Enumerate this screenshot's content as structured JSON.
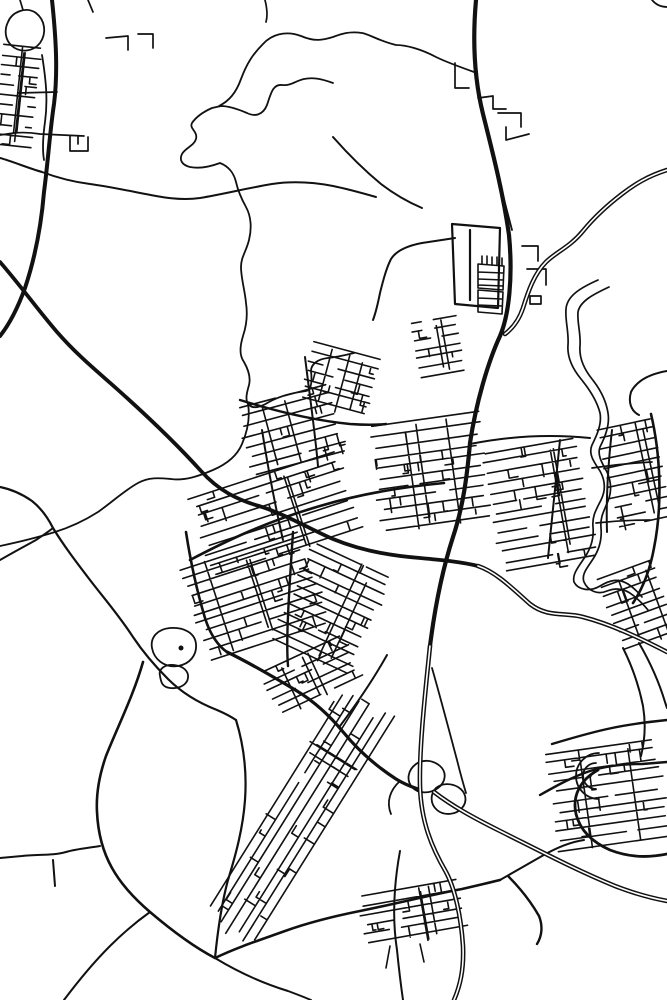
{
  "map": {
    "kind": "monochrome-street-map",
    "canvas": {
      "width": 667,
      "height": 1000,
      "background": "#ffffff",
      "ink": "#111111"
    },
    "water_boundaries": [
      {
        "n": "boundary-north-a",
        "w": 1.8,
        "d": "M 333,83 C 322,79 313,77 304,79 C 295,81 291,86 282,85 C 273,84 271,93 267,105 C 263,115 255,117 247,113 C 240,110 230,106 221,106 L 212,108 C 203,112 196,117 192,123 C 189,129 198,131 196,139 C 194,146 185,148 182,154 C 179,160 182,165 190,167 C 200,169 212,166 220,163 C 230,167 234,174 236,182 C 238,191 241,198 246,207 C 251,216 252,228 249,240 C 246,252 241,257 241,267 C 241,278 245,291 246,303 C 248,316 246,327 243,336 C 240,346 239,355 244,362 C 248,369 251,377 249,385 C 247,392 245,399 248,404 C 253,410 261,407 269,402 C 278,397 291,393 306,391 C 312,390 312,380 311,371 C 311,364 318,359 328,358 C 337,357 346,355 354,353"
      },
      {
        "n": "boundary-north-b",
        "w": 1.8,
        "d": "M 474,72 C 460,67 442,60 436,57 C 421,49 406,45 396,45 C 379,41 369,34 362,33 C 349,31 341,34 333,37 C 323,40 315,42 301,36 C 285,30 271,35 263,44 C 253,54 247,63 241,79 C 236,93 229,101 219,106"
      },
      {
        "n": "stream-nw-edge",
        "w": 1.8,
        "d": "M 248,404 C 250,416 248,430 242,444 C 237,456 227,464 213,470 C 199,476 185,481 171,479 C 159,478 149,477 138,483 C 125,490 111,503 98,512 C 87,519 71,527 55,532 C 39,537 19,542 0,546"
      },
      {
        "n": "river-bank-west",
        "w": 1.7,
        "d": "M 598,280 C 580,288 567,296 566,309 C 565,321 569,332 568,345 C 567,357 572,368 581,379 C 590,390 597,401 600,413 C 602,424 597,435 592,445 C 588,454 594,462 600,471 C 605,480 606,490 601,500 C 596,510 592,516 593,527 C 594,538 591,548 585,557 C 579,566 572,574 574,582 C 578,590 590,592 600,586 C 610,580 618,578 628,584 C 634,588 638,592 642,597"
      },
      {
        "n": "river-bank-east",
        "w": 1.7,
        "d": "M 609,287 C 594,294 580,301 578,312 C 577,323 581,333 580,346 C 579,358 584,369 592,379 C 600,389 606,400 608,413 C 610,425 605,437 600,447 C 597,455 602,463 607,472 C 611,481 612,491 608,501 C 604,511 600,517 601,528 C 602,539 599,550 593,559 C 588,567 581,574 584,582 C 588,591 598,595 607,591 C 617,587 626,589 634,596 C 640,601 644,605 648,610"
      }
    ],
    "features": [
      {
        "n": "village-loop-road",
        "w": 1.8,
        "d": "M 8,22 C 12,12 26,6 36,13 C 45,20 47,33 40,43 C 33,52 20,53 12,46 C 5,40 4,30 8,22 Z"
      },
      {
        "n": "pond-with-island",
        "w": 1.8,
        "d": "M 152,648 C 150,637 158,629 170,628 C 184,627 195,633 196,644 C 197,655 190,664 178,666 C 164,668 154,659 152,648 Z"
      },
      {
        "n": "pond-small",
        "w": 1.8,
        "d": "M 160,676 C 158,669 165,664 174,665 C 183,666 189,671 188,678 C 187,685 179,689 170,688 C 162,687 161,682 160,676 Z"
      },
      {
        "n": "industrial-outline",
        "w": 2.2,
        "d": "M 452,224 L 500,228 L 498,308 L 455,304 Z M 470,230 L 470,300"
      },
      {
        "n": "industrial-strip-block-a",
        "w": 1.6,
        "d": "M 478,264 L 504,266 L 503,290 L 478,288 Z M 478,272 L 503,273 M 478,279 L 503,280 M 478,285 L 503,286"
      },
      {
        "n": "industrial-strip-block-b",
        "w": 1.6,
        "d": "M 478,290 L 503,292 L 502,314 L 478,312 Z M 478,298 L 502,299 M 478,305 L 502,306"
      },
      {
        "n": "industrial-tick-row",
        "w": 1.6,
        "d": "M 482,256 L 482,264 M 487,256 L 487,264 M 492,257 L 492,265 M 497,257 L 497,265 M 502,258 L 502,266"
      },
      {
        "n": "industrial-east-hooks",
        "w": 1.7,
        "d": "M 522,246 L 538,246 L 538,261 M 527,269 L 546,269 L 546,285 M 530,296 L 541,296 L 541,304 L 530,304 Z"
      },
      {
        "n": "north-hook-streets",
        "w": 1.7,
        "d": "M 478,98 L 493,96 L 493,109 L 506,109 M 498,113 L 521,113 L 521,127 M 506,127 L 506,140 L 529,134"
      },
      {
        "n": "north-corner-street",
        "w": 1.7,
        "d": "M 455,63 L 455,88 L 469,88"
      },
      {
        "n": "village-u-street",
        "w": 1.7,
        "d": "M 0,135 L 14,133 C 24,132 34,133 40,134 L 84,136 M 70,136 L 70,151 L 88,151 L 88,137 M 78,136 L 78,144"
      },
      {
        "n": "village-spur",
        "w": 1.7,
        "d": "M 18,93 L 57,92"
      },
      {
        "n": "nw-hook-streets",
        "w": 1.7,
        "d": "M 106,38 L 128,36 L 128,50 M 138,34 L 153,34 L 153,48"
      },
      {
        "n": "top-edge-stubs",
        "w": 1.7,
        "d": "M 88,0 L 93,12 M 20,0 L 23,10 M 265,0 C 267,8 268,15 266,22"
      },
      {
        "n": "top-right-corner-road",
        "w": 1.8,
        "d": "M 652,0 C 656,5 661,7 667,7"
      },
      {
        "n": "far-east-hook",
        "w": 2,
        "d": "M 667,371 C 650,374 637,380 631,392 C 628,402 631,411 639,415"
      },
      {
        "n": "suburb-horseshoe",
        "w": 1.8,
        "d": "M 599,753 A 21 21 0 1 0 599,799 M 596,763 A 12 12 0 1 0 596,789"
      },
      {
        "n": "interchange-loop-a",
        "w": 1.8,
        "d": "M 416,764 C 408,770 406,780 412,787 C 418,794 430,794 438,788 C 446,782 447,772 440,766 C 433,760 423,759 416,764 Z"
      },
      {
        "n": "interchange-loop-b",
        "w": 1.8,
        "d": "M 436,788 C 430,794 430,804 437,810 C 444,816 456,815 462,808 C 468,801 466,792 458,787 C 451,783 442,783 436,788 Z"
      },
      {
        "n": "interchange-ramp",
        "w": 1.8,
        "d": "M 400,781 C 390,790 386,802 391,814"
      },
      {
        "n": "bridge-street-a",
        "w": 1.7,
        "d": "M 592,468 C 612,465 632,463 652,462"
      },
      {
        "n": "bridge-street-b",
        "w": 1.7,
        "d": "M 596,523 C 614,521 632,520 650,520"
      },
      {
        "n": "village-south-stubs",
        "w": 1.6,
        "d": "M 390,946 L 386,968 M 420,944 L 424,962"
      }
    ],
    "minor_roads": [
      {
        "n": "rural-wavy-west",
        "w": 2,
        "d": "M 0,158 C 14,162 28,168 42,172 C 58,178 74,182 90,184 C 112,187 134,192 156,196 C 172,199 186,200 200,198 C 224,194 248,188 272,184 C 292,181 312,182 333,186 C 348,189 362,193 376,197"
      },
      {
        "n": "rural-diag-north",
        "w": 2,
        "d": "M 333,137 C 348,154 364,170 381,184 C 394,194 408,202 422,208"
      },
      {
        "n": "r1-parallel-lane",
        "w": 1.8,
        "d": "M 42,55 C 46,80 48,100 45,122 C 43,136 42,148 44,160"
      },
      {
        "n": "rural-left-a",
        "w": 2.2,
        "d": "M 0,487 C 10,489 22,494 32,501 C 42,509 49,520 53,528 C 64,546 77,563 90,580 C 103,597 118,614 133,637 C 143,652 155,666 168,679 C 182,693 199,703 217,710 C 224,713 230,716 236,720"
      },
      {
        "n": "rural-left-b",
        "w": 2,
        "d": "M 0,560 C 12,553 25,546 36,540 C 42,536 48,532 53,528"
      },
      {
        "n": "wedge-ne-boundary",
        "w": 2.2,
        "d": "M 236,720 C 244,746 247,772 245,800 C 243,828 236,854 228,880 C 222,902 218,928 215,958"
      },
      {
        "n": "rural-west-junction",
        "w": 2,
        "d": "M 0,858 L 22,856 C 38,854 52,856 66,852 C 76,849 88,848 100,846 M 53,860 L 55,886"
      },
      {
        "n": "corner-road-sw",
        "w": 2,
        "d": "M 64,1000 C 76,984 92,964 110,946 C 122,934 136,922 150,912"
      },
      {
        "n": "wedge-tip-branch",
        "w": 2,
        "d": "M 215,958 C 238,972 262,983 288,991 C 296,994 304,997 311,1000"
      },
      {
        "n": "village-road-south",
        "w": 2,
        "d": "M 400,851 C 394,884 392,918 397,950 C 399,970 401,986 403,1000"
      },
      {
        "n": "junction-ne-road",
        "w": 2,
        "d": "M 500,880 C 514,872 528,864 542,856 C 556,848 570,842 584,840"
      },
      {
        "n": "c-curve-road",
        "w": 2.4,
        "d": "M 508,876 C 520,888 531,902 539,916 C 543,926 542,936 537,944"
      },
      {
        "n": "suburb-access-road",
        "w": 2.4,
        "d": "M 540,795 C 556,786 572,777 590,771 C 606,766 624,764 642,764 L 667,762"
      },
      {
        "n": "suburb-lower-arc",
        "w": 2.8,
        "d": "M 598,770 C 580,780 572,796 576,814 C 580,830 592,842 610,850 C 628,857 648,858 667,854"
      },
      {
        "n": "suburb-top-road",
        "w": 2.4,
        "d": "M 552,744 C 572,738 592,732 612,728 C 630,724 648,722 667,720"
      },
      {
        "n": "se-descent-a",
        "w": 2,
        "d": "M 623,648 C 632,666 639,686 643,706 C 646,724 645,740 641,756"
      },
      {
        "n": "se-descent-b",
        "w": 2,
        "d": "M 639,643 C 650,662 659,682 665,702 L 667,708"
      },
      {
        "n": "east-ring-road",
        "w": 2.6,
        "d": "M 651,414 C 660,452 663,503 654,548 C 650,570 643,588 633,603"
      },
      {
        "n": "industrial-west-road",
        "w": 2,
        "d": "M 455,238 L 422,243 C 406,246 396,251 391,259 C 386,269 383,281 380,293 C 378,303 376,312 373,320"
      },
      {
        "n": "m1-thin-parallel",
        "w": 1.8,
        "d": "M 484,118 C 492,152 501,188 512,230"
      },
      {
        "n": "m1-branch-se",
        "w": 1.8,
        "d": "M 432,668 C 440,696 449,730 457,760 C 460,772 463,783 466,793"
      },
      {
        "n": "strip-ne-edge",
        "w": 2,
        "d": "M 387,655 C 373,680 358,702 340,726"
      },
      {
        "n": "main-street-west",
        "w": 2.6,
        "d": "M 190,560 C 228,540 268,521 320,506 C 360,494 402,487 444,483"
      },
      {
        "n": "cross-street-west",
        "w": 2.4,
        "d": "M 240,400 C 272,410 310,420 350,424 C 364,425 376,425 386,424"
      },
      {
        "n": "vert-street-a",
        "w": 2,
        "d": "M 305,357 C 310,398 315,432 318,466"
      },
      {
        "n": "vert-street-b",
        "w": 2,
        "d": "M 262,430 C 268,468 275,505 283,540"
      },
      {
        "n": "wedge-main-street",
        "w": 2.4,
        "d": "M 293,532 C 291,562 289,592 288,616 C 287,638 287,654 288,666"
      },
      {
        "n": "east-street-a",
        "w": 2,
        "d": "M 560,440 C 556,480 552,520 548,558"
      },
      {
        "n": "east-street-b",
        "w": 2,
        "d": "M 612,430 C 608,465 606,500 607,532"
      },
      {
        "n": "east-top-street",
        "w": 2,
        "d": "M 470,444 C 510,436 550,434 590,438"
      }
    ],
    "major_roads": [
      {
        "n": "wedge-west-edge",
        "w": 2.6,
        "d": "M 186,532 C 190,558 196,588 205,618 C 210,634 218,646 227,652"
      },
      {
        "n": "south-edge-road",
        "w": 3.2,
        "d": "M 227,652 C 250,663 272,676 297,691 C 315,702 330,716 344,733 C 358,750 376,766 396,779 C 404,784 412,787 418,789"
      },
      {
        "n": "sw-sweeping-curve",
        "w": 2.6,
        "d": "M 143,662 C 134,694 118,726 106,756 C 99,776 96,794 97,812 C 98,834 103,852 112,868 C 122,886 136,900 150,912 C 170,929 192,946 215,958 C 238,947 260,940 285,931 C 310,922 335,916 360,911 C 395,904 430,895 462,889 C 475,886 488,883 500,880"
      },
      {
        "n": "nw-highway-r1",
        "w": 4,
        "d": "M 52,0 C 56,38 58,72 54,104 C 50,130 48,162 44,192 C 41,228 35,258 25,288 C 17,310 8,326 0,336"
      },
      {
        "n": "provincial-diagonal",
        "w": 3.8,
        "d": "M 0,262 C 20,285 38,310 57,332 C 78,356 98,372 117,389 C 145,414 173,440 201,471 C 219,491 238,500 259,506 C 285,514 312,530 333,539 C 362,551 393,556 420,558 C 442,560 462,562 478,566"
      },
      {
        "n": "main-ns-road",
        "w": 4.2,
        "d": "M 476,0 C 472,45 475,82 483,114 C 492,150 503,192 509,235 C 513,277 509,315 500,336 C 488,362 476,403 470,443 C 467,477 463,507 453,537 C 443,568 435,606 430,646"
      }
    ],
    "motorways": [
      {
        "n": "provincial-diagonal-se",
        "w": 4.6,
        "core": 1.6,
        "d": "M 478,566 C 496,572 512,588 530,604 C 548,618 565,612 583,617 C 610,624 638,637 667,652"
      },
      {
        "n": "motorway-ne-approach",
        "w": 4.6,
        "core": 1.6,
        "d": "M 667,170 C 648,176 635,184 622,194 C 605,207 592,220 583,231 C 570,247 556,252 546,262 C 534,274 528,292 523,308 C 519,320 513,328 505,334"
      },
      {
        "n": "motorway-ns-south",
        "w": 4.6,
        "core": 1.6,
        "d": "M 430,646 C 426,686 419,746 420,786 C 421,822 432,848 446,872 C 455,889 461,916 463,946 C 464,970 460,986 454,1000"
      },
      {
        "n": "motorway-se-branch",
        "w": 4.6,
        "core": 1.6,
        "d": "M 434,792 C 452,806 474,818 500,831 C 540,851 578,871 615,886 C 633,893 651,898 667,901"
      }
    ],
    "dots": [
      {
        "n": "pond-island-dot",
        "cx": 181,
        "cy": 648,
        "r": 2.5
      },
      {
        "n": "horseshoe-center-dot",
        "cx": 590,
        "cy": 776,
        "r": 1.6
      }
    ],
    "clusters": [
      {
        "n": "nw-village",
        "cx": 17,
        "cy": 96,
        "w": 40,
        "h": 100,
        "angle": 6,
        "pitch": 10,
        "seed": 11
      },
      {
        "n": "north-strips",
        "cx": 340,
        "cy": 382,
        "w": 72,
        "h": 62,
        "angle": 15,
        "pitch": 9,
        "seed": 23
      },
      {
        "n": "west-north",
        "cx": 292,
        "cy": 432,
        "w": 100,
        "h": 75,
        "angle": -15,
        "pitch": 10,
        "seed": 31
      },
      {
        "n": "west-south",
        "cx": 276,
        "cy": 515,
        "w": 160,
        "h": 85,
        "angle": -18,
        "pitch": 10,
        "seed": 47
      },
      {
        "n": "core-m1",
        "cx": 430,
        "cy": 475,
        "w": 115,
        "h": 110,
        "angle": -8,
        "pitch": 10.5,
        "seed": 53
      },
      {
        "n": "core-north",
        "cx": 438,
        "cy": 347,
        "w": 48,
        "h": 55,
        "angle": -10,
        "pitch": 9,
        "seed": 59
      },
      {
        "n": "east-bank",
        "cx": 540,
        "cy": 505,
        "w": 100,
        "h": 120,
        "angle": -10,
        "pitch": 10,
        "seed": 61
      },
      {
        "n": "far-east",
        "cx": 634,
        "cy": 472,
        "w": 58,
        "h": 100,
        "angle": -12,
        "pitch": 10,
        "seed": 67
      },
      {
        "n": "wedge-a",
        "cx": 255,
        "cy": 595,
        "w": 130,
        "h": 95,
        "angle": -18,
        "pitch": 9.5,
        "seed": 71
      },
      {
        "n": "wedge-b",
        "cx": 330,
        "cy": 610,
        "w": 90,
        "h": 110,
        "angle": 25,
        "pitch": 9.5,
        "seed": 73
      },
      {
        "n": "wedge-bridge",
        "cx": 312,
        "cy": 678,
        "w": 95,
        "h": 50,
        "angle": -25,
        "pitch": 9,
        "seed": 79
      },
      {
        "n": "sw-strip",
        "cx": 298,
        "cy": 815,
        "w": 280,
        "h": 60,
        "angle": 122,
        "pitch": 9.5,
        "seed": 83
      },
      {
        "n": "se-suburb",
        "cx": 608,
        "cy": 795,
        "w": 115,
        "h": 100,
        "angle": -8,
        "pitch": 10,
        "seed": 89
      },
      {
        "n": "se-upper",
        "cx": 638,
        "cy": 606,
        "w": 60,
        "h": 78,
        "angle": -20,
        "pitch": 9.5,
        "seed": 97
      },
      {
        "n": "bottom-village",
        "cx": 413,
        "cy": 916,
        "w": 105,
        "h": 55,
        "angle": -10,
        "pitch": 9.5,
        "seed": 101
      }
    ]
  }
}
